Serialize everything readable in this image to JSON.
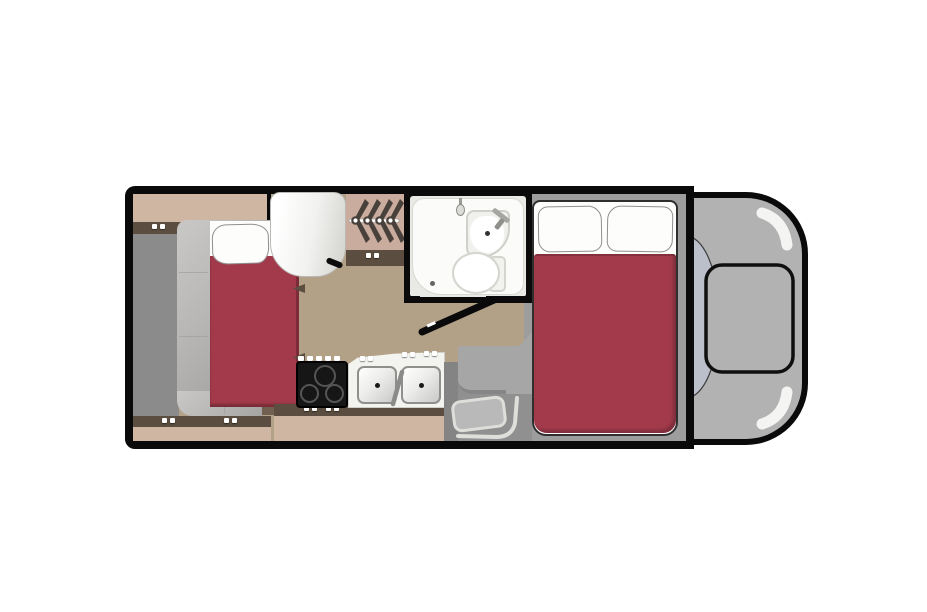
{
  "title": "Cab-over motorhome floor plan (top view)",
  "diagram_type": "rv-floorplan",
  "colors": {
    "outline": "#0a0a0a",
    "floor": "#b3a187",
    "panel": "#8b8b8b",
    "cabinetFace": "#cfb6a2",
    "cabinetEdge": "#5b4d3f",
    "sofa": "#b7b6b5",
    "sofaEdge": "#9e9d9c",
    "bedRed": "#a23a4b",
    "bedRedEdge": "#7c2c39",
    "sheetWhite": "#fdfdfc",
    "underBed": "#6f604f",
    "fridgeDark": "#d5d5d2",
    "wardrobeBg": "#c9ac9d",
    "hanger": "#48403a",
    "bathWhite": "#fbfbf9",
    "stoveBlack": "#161616",
    "burnerRing": "#555555",
    "counterWhite": "#f3f3f0",
    "steel": "#8f8f8d",
    "bunkGray": "#9d9d9d",
    "cabGray": "#b2b2b2",
    "windshield": "#babfca",
    "highlight": "#f4f4f3",
    "stepGray": "#a6a6a6",
    "wellGray": "#909090",
    "matGray": "#b9b9b9",
    "matEdge": "#dededb"
  },
  "furniture": {
    "twin_bed": "Twin bed with pillow",
    "sofa_frame": "Upholstered bed surround",
    "overhead_cabinet": "Overhead cabinet",
    "base_cabinet": "Base cabinet",
    "refrigerator": "Refrigerator",
    "wardrobe": "Wardrobe with 4 hangers",
    "bathroom": "Wet bath",
    "shower": "Shower",
    "shower_head": "Shower head",
    "bathroom_sink": "Corner sink",
    "toilet": "Toilet",
    "bathroom_door": "Bathroom door (open)",
    "stove": "3-burner stove",
    "kitchen_sink": "Double-bowl kitchen sink",
    "kitchen_counter": "Kitchen counter",
    "entry_step": "Entry step well with mat",
    "cabover_bed": "Cab-over double bed with two pillows",
    "cab": "Driver cab",
    "hood": "Hood",
    "windshield": "Windshield"
  },
  "counts": {
    "beds": 2,
    "pillows": 3,
    "burners": 3,
    "sink_bowls": 2,
    "hangers": 4
  }
}
